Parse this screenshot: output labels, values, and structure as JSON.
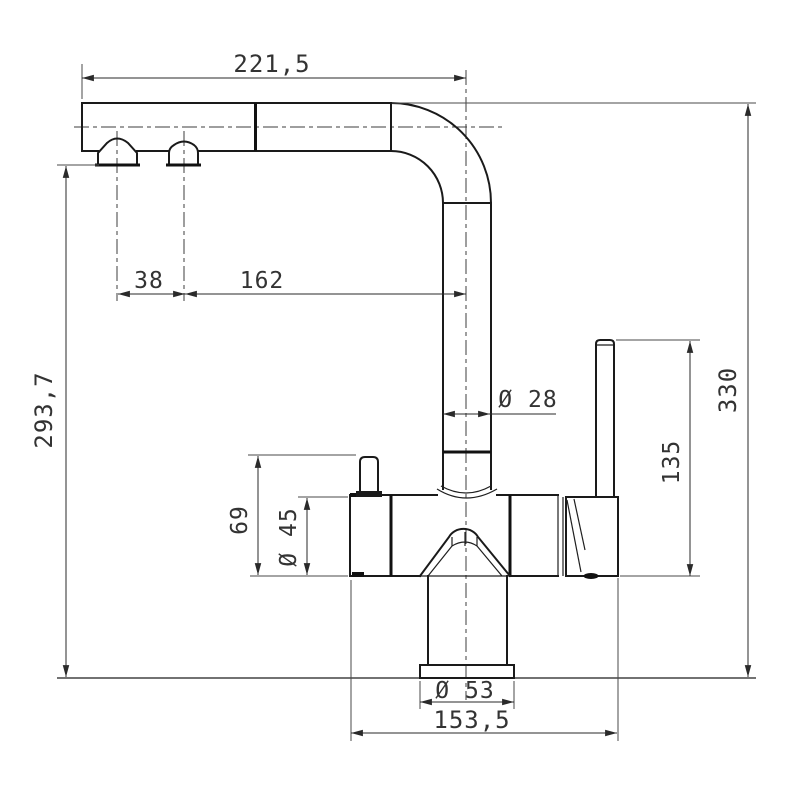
{
  "drawing": {
    "type": "technical-dimension-drawing",
    "subject": "kitchen-faucet-side-view",
    "colors": {
      "background": "#ffffff",
      "outline": "#1a1a1a",
      "dimension": "#2a2a2a"
    },
    "labels": {
      "spout_reach": "221,5",
      "outlet_spacing": "38",
      "outlet_to_riser": "162",
      "outlet_height": "293,7",
      "riser_diameter": "Ø 28",
      "total_height": "330",
      "lever_height": "135",
      "knob_height": "69",
      "body_diameter": "Ø 45",
      "base_diameter": "Ø 53",
      "body_span": "153,5"
    }
  }
}
